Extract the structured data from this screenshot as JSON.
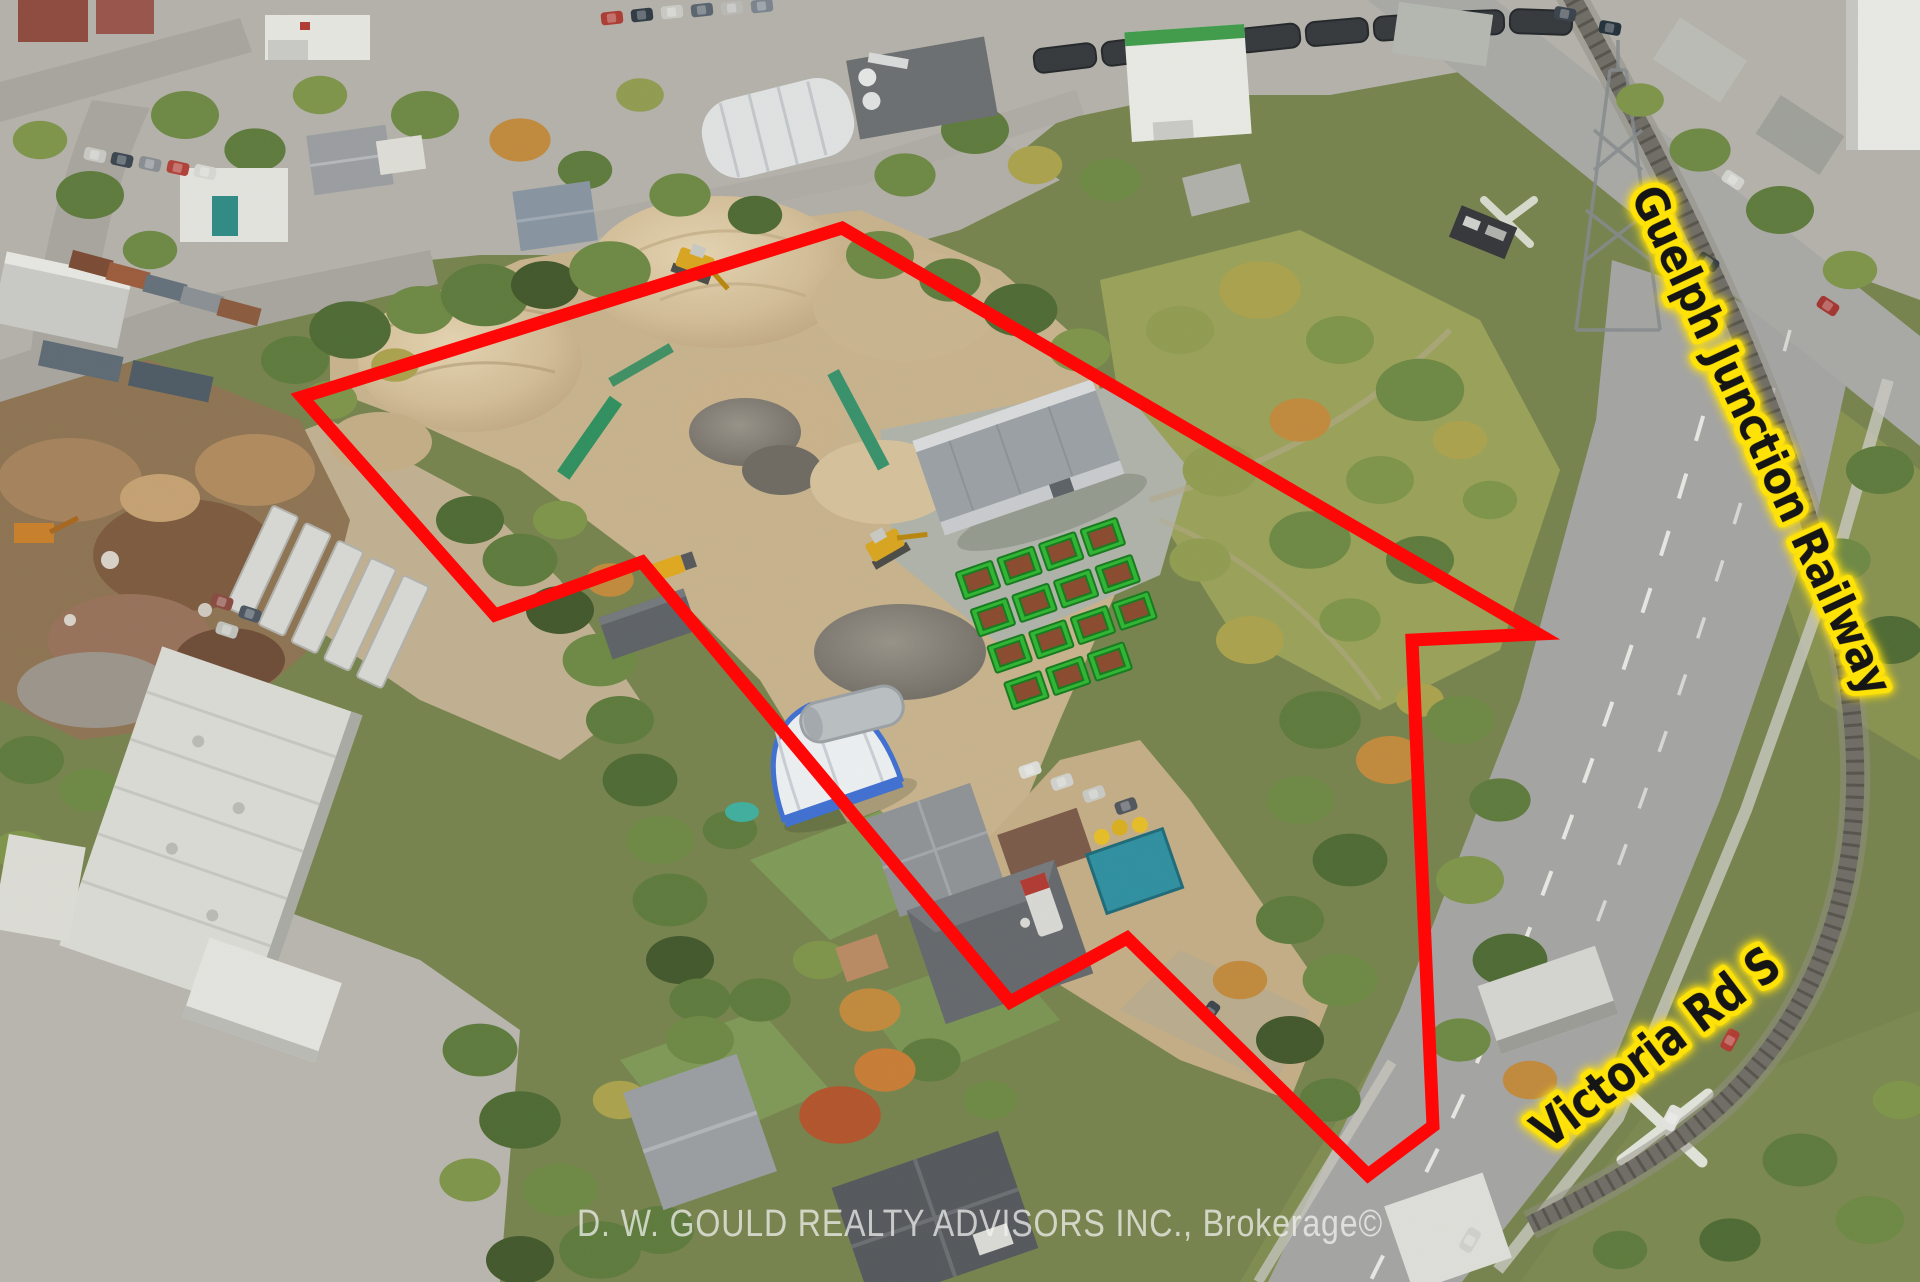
{
  "photo": {
    "type": "aerial-property-listing-photo",
    "annotations": {
      "railway_label": "Guelph Junction Railway",
      "road_label": "Victoria Rd S",
      "watermark": "D. W. GOULD REALTY ADVISORS INC., Brokerage©"
    },
    "boundary": {
      "points": "842,228 1538,634 1412,640 1433,1126 1368,1175 1127,938 1010,1002 642,562 495,615 302,397",
      "color": "#ff0707",
      "stroke_width": 13
    },
    "colors": {
      "label_text": "#151515",
      "label_glow": "#ffe207",
      "watermark_text": "rgba(244,244,242,0.72)"
    }
  }
}
